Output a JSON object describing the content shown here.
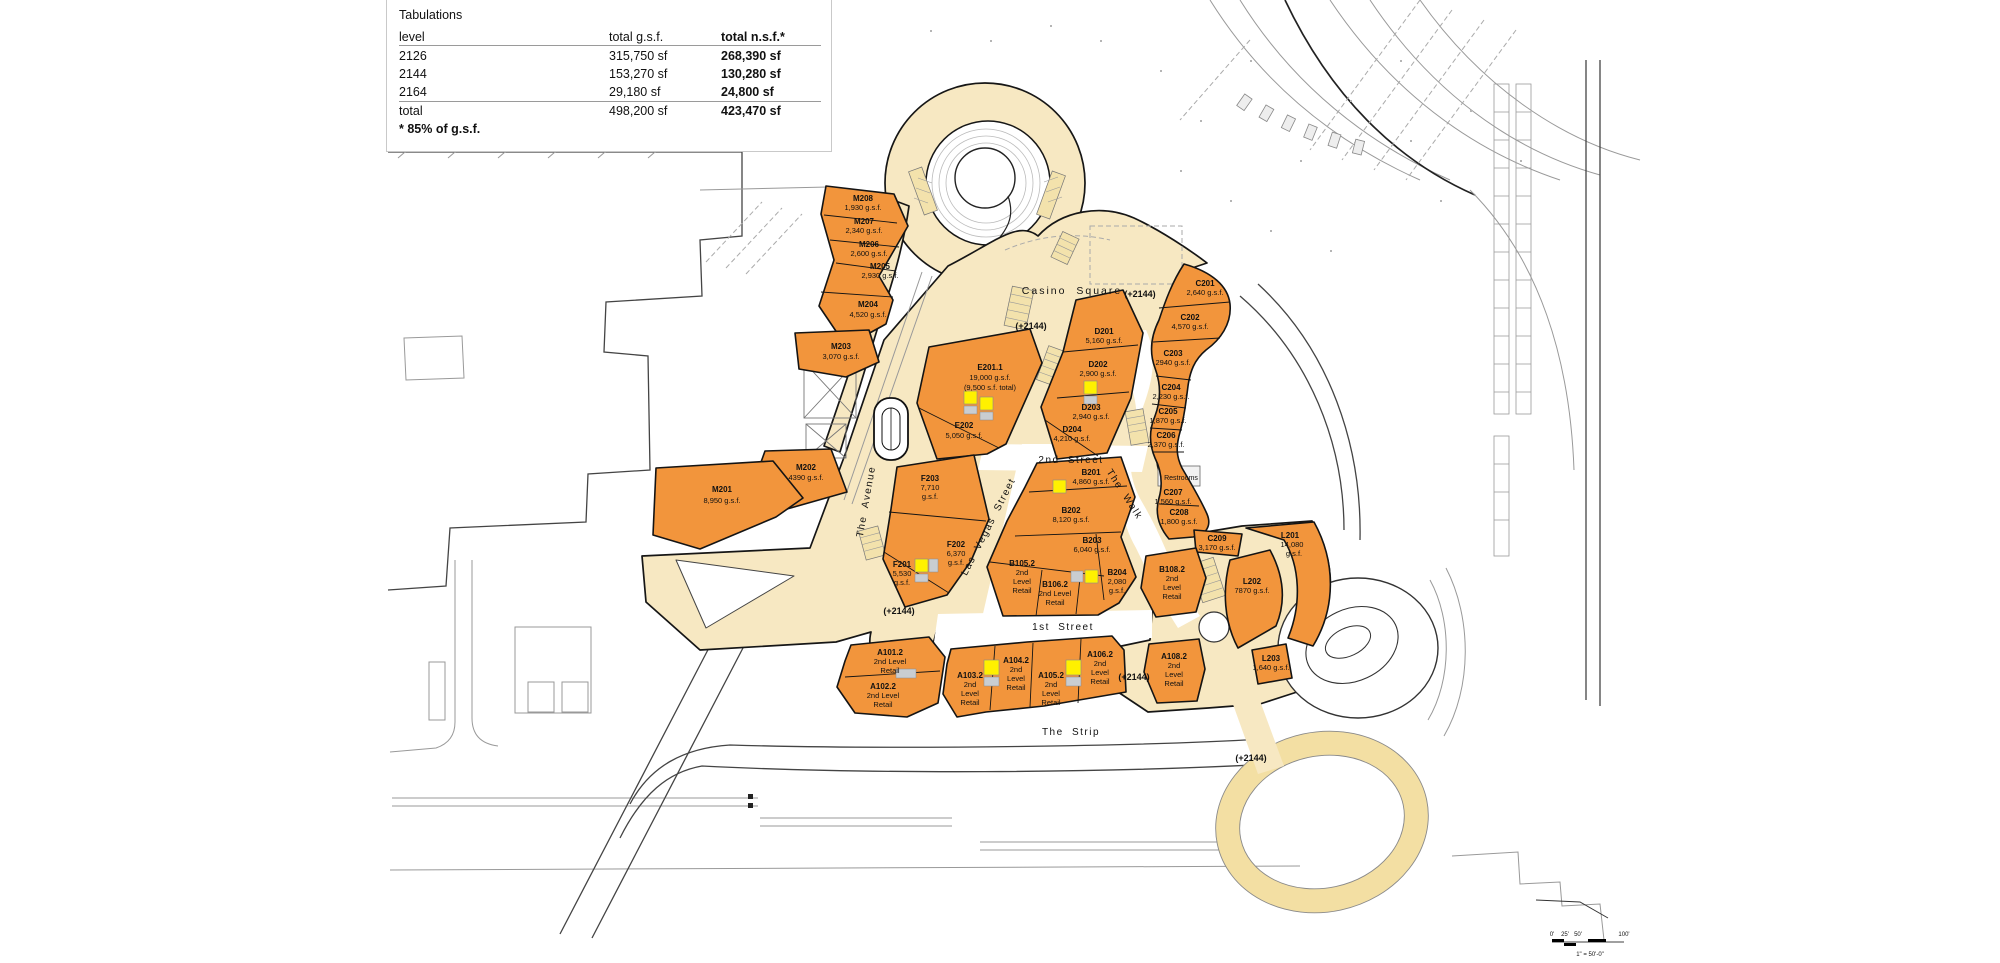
{
  "tabulations": {
    "title": "Tabulations",
    "columns": [
      "level",
      "total g.s.f.",
      "total n.s.f.*"
    ],
    "rows": [
      [
        "2126",
        "315,750 sf",
        "268,390 sf"
      ],
      [
        "2144",
        "153,270 sf",
        "130,280 sf"
      ],
      [
        "2164",
        "29,180 sf",
        "24,800 sf"
      ]
    ],
    "total_row": [
      "total",
      "498,200 sf",
      "423,470 sf"
    ],
    "footnote": "* 85% of g.s.f."
  },
  "labels": {
    "casino_square": "Casino Square",
    "second_street": "2nd Street",
    "first_street": "1st Street",
    "the_strip": "The Strip",
    "the_walk": "The Walk",
    "the_avenue": "The Avenue",
    "las_vegas_street": "Las Vegas Street",
    "restrooms": "Restrooms",
    "level_marker": "(+2144)"
  },
  "buildings": {
    "m208": [
      "M208",
      "1,930 g.s.f."
    ],
    "m207": [
      "M207",
      "2,340 g.s.f."
    ],
    "m206": [
      "M206",
      "2,600 g.s.f."
    ],
    "m205": [
      "M205",
      "2,930 g.s.f."
    ],
    "m204": [
      "M204",
      "4,520 g.s.f."
    ],
    "m203": [
      "M203",
      "3,070 g.s.f."
    ],
    "m202": [
      "M202",
      "4390 g.s.f."
    ],
    "m201": [
      "M201",
      "8,950 g.s.f."
    ],
    "e201_1": [
      "E201.1",
      "19,000 g.s.f.",
      "(9,500 s.f. total)"
    ],
    "e202": [
      "E202",
      "5,050 g.s.f."
    ],
    "f203": [
      "F203",
      "7,710",
      "g.s.f."
    ],
    "f202": [
      "F202",
      "6,370",
      "g.s.f."
    ],
    "f201": [
      "F201",
      "5,530",
      "g.s.f."
    ],
    "d201": [
      "D201",
      "5,160 g.s.f."
    ],
    "d202": [
      "D202",
      "2,900 g.s.f."
    ],
    "d203": [
      "D203",
      "2,940 g.s.f."
    ],
    "d204": [
      "D204",
      "4,210 g.s.f."
    ],
    "c201": [
      "C201",
      "2,640 g.s.f."
    ],
    "c202": [
      "C202",
      "4,570 g.s.f."
    ],
    "c203": [
      "C203",
      "2940 g.s.f."
    ],
    "c204": [
      "C204",
      "2,230 g.s.f."
    ],
    "c205": [
      "C205",
      "1,870 g.s.f."
    ],
    "c206": [
      "C206",
      "2,370 g.s.f."
    ],
    "c207": [
      "C207",
      "1,560 g.s.f."
    ],
    "c208": [
      "C208",
      "1,800 g.s.f."
    ],
    "c209": [
      "C209",
      "3,170 g.s.f."
    ],
    "l201": [
      "L201",
      "14,080",
      "g.s.f."
    ],
    "l202": [
      "L202",
      "7870 g.s.f."
    ],
    "l203": [
      "L203",
      "1,640 g.s.f."
    ],
    "b201": [
      "B201",
      "4,860 g.s.f."
    ],
    "b202": [
      "B202",
      "8,120 g.s.f."
    ],
    "b203": [
      "B203",
      "6,040 g.s.f."
    ],
    "b204": [
      "B204",
      "2,080",
      "g.s.f."
    ],
    "b105_2": [
      "B105.2",
      "2nd",
      "Level",
      "Retail"
    ],
    "b106_2": [
      "B106.2",
      "2nd Level",
      "Retail"
    ],
    "b108_2": [
      "B108.2",
      "2nd",
      "Level",
      "Retail"
    ],
    "a101_2": [
      "A101.2",
      "2nd Level",
      "Retail"
    ],
    "a102_2": [
      "A102.2",
      "2nd Level",
      "Retail"
    ],
    "a103_2": [
      "A103.2",
      "2nd",
      "Level",
      "Retail"
    ],
    "a104_2": [
      "A104.2",
      "2nd",
      "Level",
      "Retail"
    ],
    "a105_2": [
      "A105.2",
      "2nd",
      "Level",
      "Retail"
    ],
    "a106_2": [
      "A106.2",
      "2nd",
      "Level",
      "Retail"
    ],
    "a108_2": [
      "A108.2",
      "2nd",
      "Level",
      "Retail"
    ]
  },
  "scale": {
    "ticks": [
      "0'",
      "25'",
      "50'",
      "100'"
    ],
    "note": "1\" = 50'-0\""
  },
  "colors": {
    "building_fill": "#F2953C",
    "walkway_fill": "#F7E8C2",
    "ring_fill": "#F3DFA3",
    "elevator_yellow": "#FFF100",
    "stair_gray": "#C9CDD1"
  }
}
